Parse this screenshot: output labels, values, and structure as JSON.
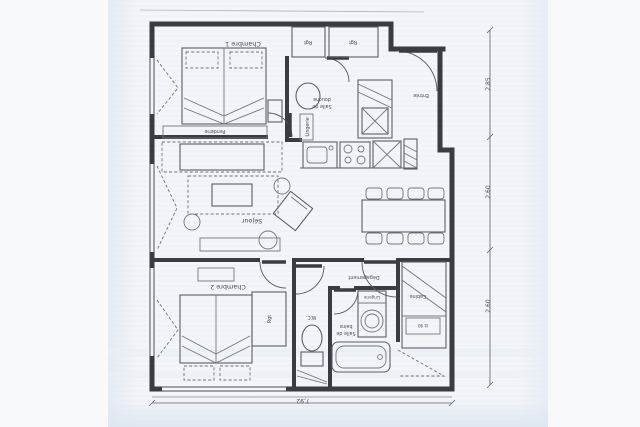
{
  "rooms": {
    "chambre1": "Chambre 1",
    "sejour": "Séjour",
    "chambre2": "Chambre 2",
    "entree": "Entrée",
    "degagement": "Dégagement",
    "wc": "W.C.",
    "cabine": "Cabine",
    "salle_de_douche": {
      "line1": "Salle de",
      "line2": "douche"
    },
    "salle_de_bains": {
      "line1": "Salle de",
      "line2": "bains"
    }
  },
  "storage": {
    "rgt_entry_left": "Rgt",
    "rgt_entry_right": "Rgt",
    "rgt_chambre2": "Rgt",
    "penderie": "Penderie",
    "lingerie": "Lingerie",
    "lit_90": "lit 90"
  },
  "dimensions": {
    "right_top": "2,85",
    "right_middle": "2,60",
    "right_bottom": "2,60",
    "bottom_width": "7,92"
  }
}
